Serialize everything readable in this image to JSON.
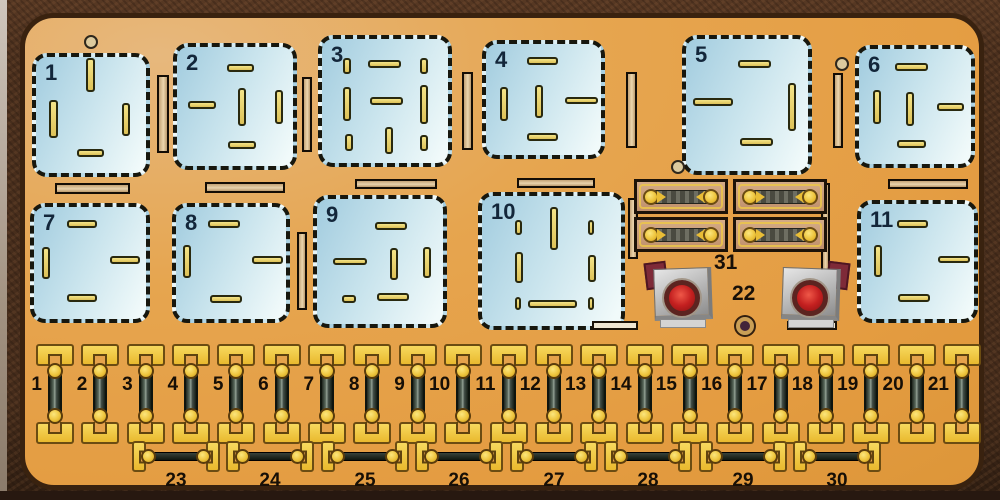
{
  "diagram": {
    "description": "Car fuse and relay panel diagram",
    "label31": "31",
    "label22": "22",
    "colors": {
      "panel_orange": "#e5a24b",
      "panel_border": "#39220f",
      "photo_background": "#4a2f1d",
      "relay_socket_blue": "#c9e4ed",
      "relay_outline": "#17170e",
      "slot_yellow": "#ecd873",
      "connector_bar_tan": "#d9bc92",
      "fuse_yellow": "#f2c945",
      "fuse_body_dark": "#3a443a",
      "holder_body_tan": "#c59c7b",
      "button_gray": "#bfbfbf",
      "button_red": "#c42020",
      "flap_dark_red": "#7e2a38",
      "relay_number_color": "#13263a",
      "fuse_number_color": "#170f06"
    },
    "relays": [
      {
        "label": "1",
        "box": [
          32,
          53,
          118,
          124
        ],
        "slots": [
          [
            86,
            58,
            9,
            34
          ],
          [
            49,
            100,
            9,
            38
          ],
          [
            122,
            103,
            8,
            33
          ],
          [
            77,
            149,
            27,
            8
          ]
        ]
      },
      {
        "label": "2",
        "box": [
          173,
          43,
          124,
          127
        ],
        "slots": [
          [
            227,
            64,
            27,
            8
          ],
          [
            188,
            101,
            28,
            8
          ],
          [
            238,
            88,
            8,
            38
          ],
          [
            275,
            90,
            8,
            34
          ],
          [
            228,
            141,
            28,
            8
          ]
        ]
      },
      {
        "label": "3",
        "box": [
          318,
          35,
          134,
          132
        ],
        "slots": [
          [
            343,
            58,
            8,
            16
          ],
          [
            368,
            60,
            33,
            8
          ],
          [
            420,
            58,
            8,
            16
          ],
          [
            343,
            87,
            8,
            34
          ],
          [
            370,
            97,
            33,
            8
          ],
          [
            420,
            85,
            8,
            39
          ],
          [
            345,
            134,
            8,
            17
          ],
          [
            385,
            127,
            8,
            27
          ],
          [
            420,
            135,
            8,
            16
          ]
        ]
      },
      {
        "label": "4",
        "box": [
          482,
          40,
          123,
          119
        ],
        "slots": [
          [
            527,
            57,
            31,
            8
          ],
          [
            500,
            87,
            8,
            34
          ],
          [
            535,
            85,
            8,
            33
          ],
          [
            565,
            97,
            33,
            7
          ],
          [
            527,
            133,
            31,
            8
          ]
        ]
      },
      {
        "label": "5",
        "box": [
          682,
          35,
          130,
          140
        ],
        "slots": [
          [
            738,
            60,
            33,
            8
          ],
          [
            693,
            98,
            40,
            8
          ],
          [
            788,
            83,
            8,
            48
          ],
          [
            740,
            138,
            33,
            8
          ]
        ]
      },
      {
        "label": "6",
        "box": [
          855,
          45,
          120,
          123
        ],
        "slots": [
          [
            895,
            63,
            33,
            8
          ],
          [
            873,
            90,
            8,
            34
          ],
          [
            906,
            92,
            8,
            34
          ],
          [
            937,
            103,
            27,
            8
          ],
          [
            897,
            140,
            29,
            8
          ]
        ]
      },
      {
        "label": "7",
        "box": [
          30,
          203,
          120,
          120
        ],
        "slots": [
          [
            67,
            220,
            30,
            8
          ],
          [
            42,
            247,
            8,
            32
          ],
          [
            110,
            256,
            30,
            8
          ],
          [
            67,
            294,
            30,
            8
          ]
        ]
      },
      {
        "label": "8",
        "box": [
          172,
          203,
          118,
          120
        ],
        "slots": [
          [
            208,
            220,
            32,
            8
          ],
          [
            183,
            245,
            8,
            33
          ],
          [
            252,
            256,
            31,
            8
          ],
          [
            210,
            295,
            32,
            8
          ]
        ]
      },
      {
        "label": "9",
        "box": [
          313,
          195,
          134,
          133
        ],
        "slots": [
          [
            375,
            222,
            32,
            8
          ],
          [
            333,
            258,
            34,
            7
          ],
          [
            390,
            248,
            8,
            32
          ],
          [
            423,
            247,
            8,
            31
          ],
          [
            342,
            295,
            14,
            8
          ],
          [
            377,
            293,
            32,
            8
          ]
        ]
      },
      {
        "label": "10",
        "box": [
          478,
          192,
          147,
          138
        ],
        "slots": [
          [
            515,
            220,
            7,
            15
          ],
          [
            550,
            207,
            8,
            43
          ],
          [
            588,
            220,
            6,
            15
          ],
          [
            515,
            252,
            8,
            31
          ],
          [
            588,
            255,
            8,
            27
          ],
          [
            515,
            297,
            6,
            13
          ],
          [
            528,
            300,
            49,
            8
          ],
          [
            588,
            297,
            6,
            13
          ]
        ]
      },
      {
        "label": "11",
        "box": [
          857,
          200,
          121,
          123
        ],
        "slots": [
          [
            897,
            220,
            31,
            8
          ],
          [
            874,
            245,
            8,
            32
          ],
          [
            938,
            256,
            32,
            7
          ],
          [
            898,
            294,
            32,
            8
          ]
        ]
      }
    ],
    "vertical_bars": [
      [
        157,
        75,
        12,
        78
      ],
      [
        302,
        77,
        10,
        75
      ],
      [
        462,
        72,
        11,
        78
      ],
      [
        626,
        72,
        11,
        76
      ],
      [
        833,
        73,
        10,
        75
      ],
      [
        297,
        232,
        10,
        78
      ],
      [
        628,
        198,
        10,
        61
      ],
      [
        821,
        183,
        9,
        93
      ]
    ],
    "horizontal_bars": [
      [
        55,
        183,
        75,
        11
      ],
      [
        205,
        182,
        80,
        11
      ],
      [
        355,
        179,
        82,
        10
      ],
      [
        517,
        178,
        78,
        10
      ],
      [
        888,
        179,
        80,
        10
      ]
    ],
    "light_bars": [
      [
        592,
        321,
        46,
        9
      ],
      [
        787,
        321,
        50,
        9
      ]
    ],
    "rings": [
      [
        89,
        40
      ],
      [
        840,
        62
      ],
      [
        676,
        165
      ]
    ],
    "fuse_row_top": {
      "labels": [
        "1",
        "2",
        "3",
        "4",
        "5",
        "6",
        "7",
        "8",
        "9",
        "10",
        "11",
        "12",
        "13",
        "14",
        "15",
        "16",
        "17",
        "18",
        "19",
        "20",
        "21"
      ],
      "start_x": 55,
      "step": 45.35,
      "top": 344
    },
    "fuse_row_bottom": {
      "labels": [
        "23",
        "24",
        "25",
        "26",
        "27",
        "28",
        "29",
        "30"
      ],
      "centers": [
        176,
        270,
        365,
        459,
        554,
        648,
        743,
        837
      ],
      "top": 441
    },
    "fuse_holders": {
      "cols": [
        634,
        733
      ],
      "rows": [
        179,
        217
      ],
      "w": 94,
      "h": 35
    },
    "buttons": [
      {
        "x": 648,
        "y": 262,
        "flap": "l"
      },
      {
        "x": 776,
        "y": 262,
        "flap": "r"
      }
    ]
  }
}
